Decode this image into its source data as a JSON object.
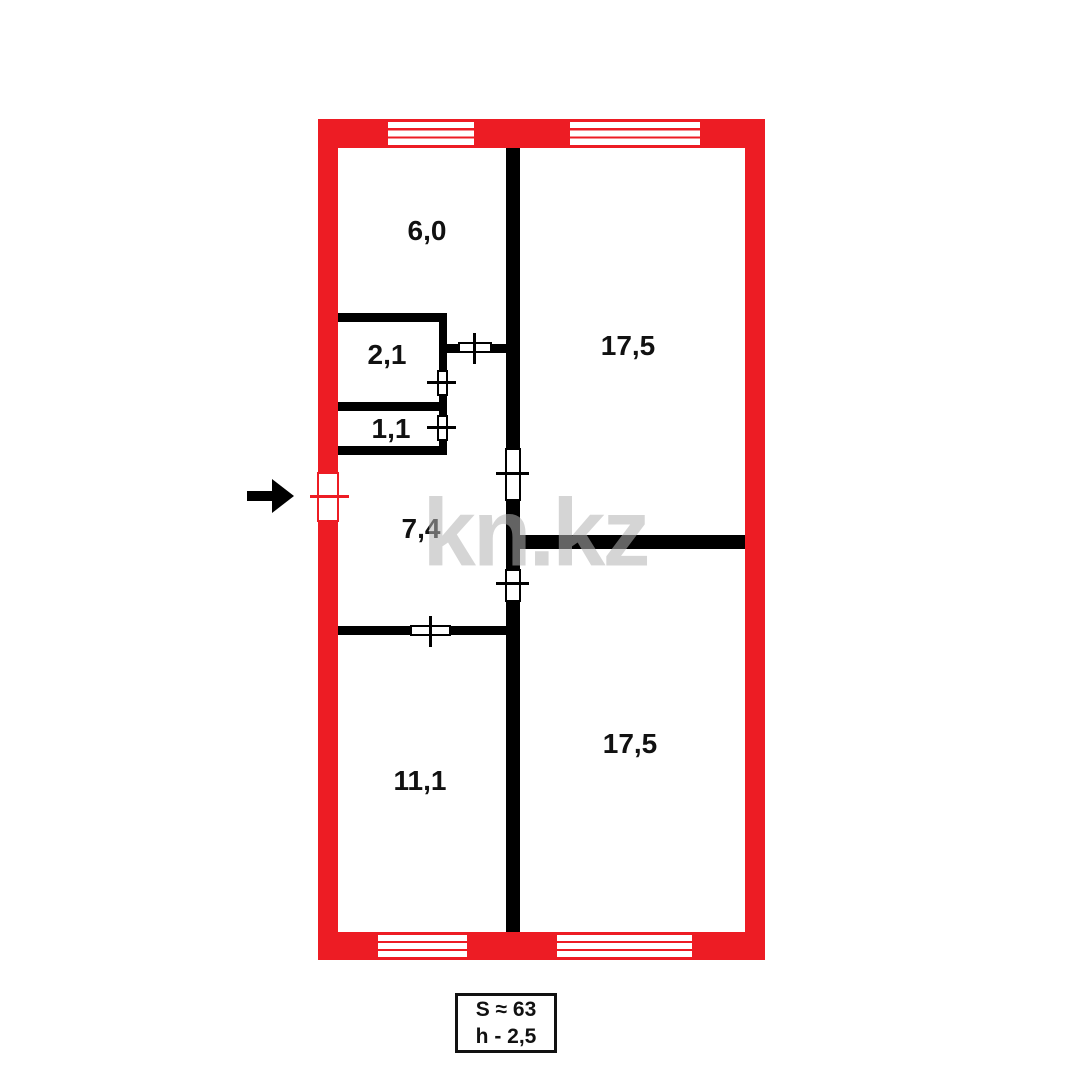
{
  "colors": {
    "wall_red": "#ed1c24",
    "wall_black": "#000000",
    "background": "#ffffff",
    "watermark_gray": "#b4b4b4"
  },
  "watermark": {
    "text": "kn.kz",
    "cx": 535,
    "cy": 538
  },
  "info_box": {
    "line1": "S ≈ 63",
    "line2": "h - 2,5",
    "x": 455,
    "y": 993,
    "w": 102,
    "h": 60
  },
  "entrance_arrow": {
    "direction": "right",
    "shaft_x": 247,
    "shaft_y": 491,
    "head_x": 272,
    "head_y": 479
  },
  "plan": {
    "outer_walls": [
      {
        "name": "outer-wall-top",
        "x": 318,
        "y": 119,
        "w": 447,
        "h": 29
      },
      {
        "name": "outer-wall-bottom",
        "x": 318,
        "y": 932,
        "w": 447,
        "h": 28
      },
      {
        "name": "outer-wall-left",
        "x": 318,
        "y": 119,
        "w": 20,
        "h": 841
      },
      {
        "name": "outer-wall-right",
        "x": 745,
        "y": 119,
        "w": 20,
        "h": 841
      }
    ],
    "interior_walls": [
      {
        "name": "wall-central-vertical",
        "x": 506,
        "y": 148,
        "w": 14,
        "h": 784
      },
      {
        "name": "wall-closet21-top",
        "x": 338,
        "y": 313,
        "w": 108,
        "h": 9
      },
      {
        "name": "wall-closets-right",
        "x": 439,
        "y": 313,
        "w": 8,
        "h": 142
      },
      {
        "name": "wall-closet21-11-divider",
        "x": 338,
        "y": 402,
        "w": 108,
        "h": 9
      },
      {
        "name": "wall-closet11-bottom",
        "x": 338,
        "y": 446,
        "w": 108,
        "h": 9
      },
      {
        "name": "wall-hall-top",
        "x": 446,
        "y": 344,
        "w": 60,
        "h": 9
      },
      {
        "name": "wall-rooms-divider",
        "x": 520,
        "y": 535,
        "w": 225,
        "h": 14
      },
      {
        "name": "wall-hall-room111",
        "x": 338,
        "y": 626,
        "w": 168,
        "h": 9
      }
    ],
    "windows": [
      {
        "name": "window-top-left",
        "x": 388,
        "y": 122,
        "w": 86,
        "h": 23
      },
      {
        "name": "window-top-right",
        "x": 570,
        "y": 122,
        "w": 130,
        "h": 23
      },
      {
        "name": "window-bottom-left",
        "x": 378,
        "y": 935,
        "w": 89,
        "h": 22
      },
      {
        "name": "window-bottom-right",
        "x": 557,
        "y": 935,
        "w": 135,
        "h": 22
      }
    ],
    "doors": [
      {
        "name": "door-closet21",
        "gap": {
          "x": 437,
          "y": 370,
          "w": 11,
          "h": 26
        },
        "tick": {
          "x": 427,
          "y": 381,
          "w": 29,
          "h": 3
        },
        "red": false
      },
      {
        "name": "door-closet11",
        "gap": {
          "x": 437,
          "y": 415,
          "w": 11,
          "h": 26
        },
        "tick": {
          "x": 427,
          "y": 426,
          "w": 29,
          "h": 3
        },
        "red": false
      },
      {
        "name": "door-hall-top",
        "gap": {
          "x": 458,
          "y": 342,
          "w": 34,
          "h": 11
        },
        "tick": {
          "x": 473,
          "y": 333,
          "w": 3,
          "h": 31
        },
        "red": false
      },
      {
        "name": "door-room175-upper",
        "gap": {
          "x": 505,
          "y": 448,
          "w": 16,
          "h": 53
        },
        "tick": {
          "x": 496,
          "y": 472,
          "w": 33,
          "h": 3
        },
        "red": false
      },
      {
        "name": "door-room175-lower",
        "gap": {
          "x": 505,
          "y": 569,
          "w": 16,
          "h": 33
        },
        "tick": {
          "x": 496,
          "y": 582,
          "w": 33,
          "h": 3
        },
        "red": false
      },
      {
        "name": "door-room111",
        "gap": {
          "x": 410,
          "y": 625,
          "w": 41,
          "h": 11
        },
        "tick": {
          "x": 429,
          "y": 616,
          "w": 3,
          "h": 31
        },
        "red": false
      },
      {
        "name": "door-entrance",
        "gap": {
          "x": 317,
          "y": 472,
          "w": 22,
          "h": 50
        },
        "tick": {
          "x": 310,
          "y": 495,
          "w": 39,
          "h": 3
        },
        "red": true
      }
    ],
    "rooms": [
      {
        "name": "room-label-6-0",
        "label": "6,0",
        "cx": 427,
        "cy": 231
      },
      {
        "name": "room-label-2-1",
        "label": "2,1",
        "cx": 387,
        "cy": 355
      },
      {
        "name": "room-label-1-1",
        "label": "1,1",
        "cx": 391,
        "cy": 429
      },
      {
        "name": "room-label-7-4",
        "label": "7,4",
        "cx": 421,
        "cy": 529
      },
      {
        "name": "room-label-17-5-upper",
        "label": "17,5",
        "cx": 628,
        "cy": 346
      },
      {
        "name": "room-label-17-5-lower",
        "label": "17,5",
        "cx": 630,
        "cy": 744
      },
      {
        "name": "room-label-11-1",
        "label": "11,1",
        "cx": 420,
        "cy": 781
      }
    ]
  }
}
